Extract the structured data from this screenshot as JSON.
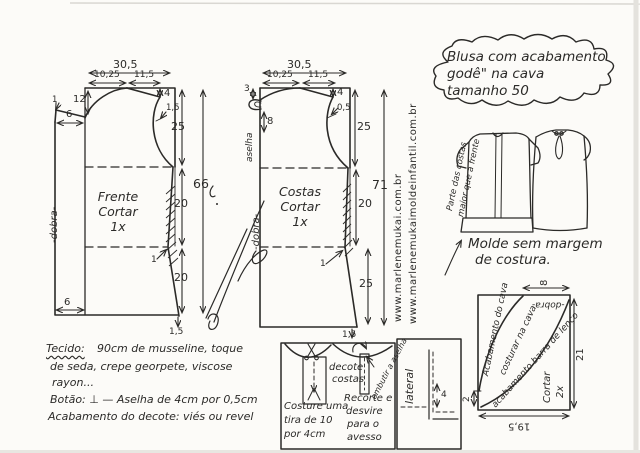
{
  "title": {
    "lines": [
      "Blusa com acabamento",
      "godê\" na cava",
      "tamanho 50"
    ]
  },
  "front": {
    "name": "Frente",
    "cut": "Cortar",
    "qty": "1x",
    "fold": "-dobra-",
    "m": {
      "top_total": "30,5",
      "neck_w": "10,25",
      "shoulder_w": "11,5",
      "neck_depth": "12",
      "tip": "1",
      "shoulder_ext": "6",
      "shoulder_drop": "4",
      "armhole_notch": "1,5",
      "armhole": "25",
      "waist": "20",
      "hip": "20",
      "waist_in": "1",
      "hem_drop": "1,5",
      "hem_ext": "6",
      "total": "66"
    }
  },
  "back": {
    "name": "Costas",
    "cut": "Cortar",
    "qty": "1x",
    "fold": "-dobra-",
    "loop_label": "aselha",
    "m": {
      "top_total": "30,5",
      "neck_w": "10,25",
      "shoulder_w": "11,5",
      "neck_rise": "3",
      "loop": "8",
      "shoulder_drop": "4",
      "armhole_notch": "0,5",
      "armhole": "25",
      "waist": "20",
      "hip": "25",
      "waist_in": "1",
      "hem_drop": "1,5",
      "total": "71"
    }
  },
  "websites": {
    "main": "www.marlenemukai.com.br",
    "infantil": "www.marlenemukaimoldeinfantil.com.br"
  },
  "sketch": {
    "note1": "Parte das costas",
    "note2": "maior que a frente",
    "caption1": "Molde sem margem",
    "caption2": "de costura."
  },
  "notes": {
    "tecido_label": "Tecido:",
    "tecido_rest": "90cm de musseline, toque",
    "line2": "de seda, crepe georpete, viscose",
    "line3": "rayon...",
    "line4": "Botão: ⊥ — Aselha de 4cm por 0,5cm",
    "line5": "Acabamento do decote: viés ou revel"
  },
  "detail": {
    "sew1": "Costure uma",
    "sew2": "tira de 10",
    "sew3": "por 4cm",
    "neck1": "decote",
    "neck2": "costas",
    "tuck": "embutir a aselha",
    "cut1": "Recorte e",
    "cut2": "desvire",
    "cut3": "para o",
    "cut4": "avesso"
  },
  "lateral": {
    "label": "lateral",
    "m": "4"
  },
  "gode": {
    "finish": "Acabamento do cava",
    "sew": "costurar na cava",
    "hem": "acabamento barra de lenço",
    "fold": "-dobra-",
    "cut": "Cortar",
    "qty": "2x",
    "m": {
      "top": "8",
      "side": "21",
      "bottom": "19,5",
      "left": "2"
    }
  }
}
